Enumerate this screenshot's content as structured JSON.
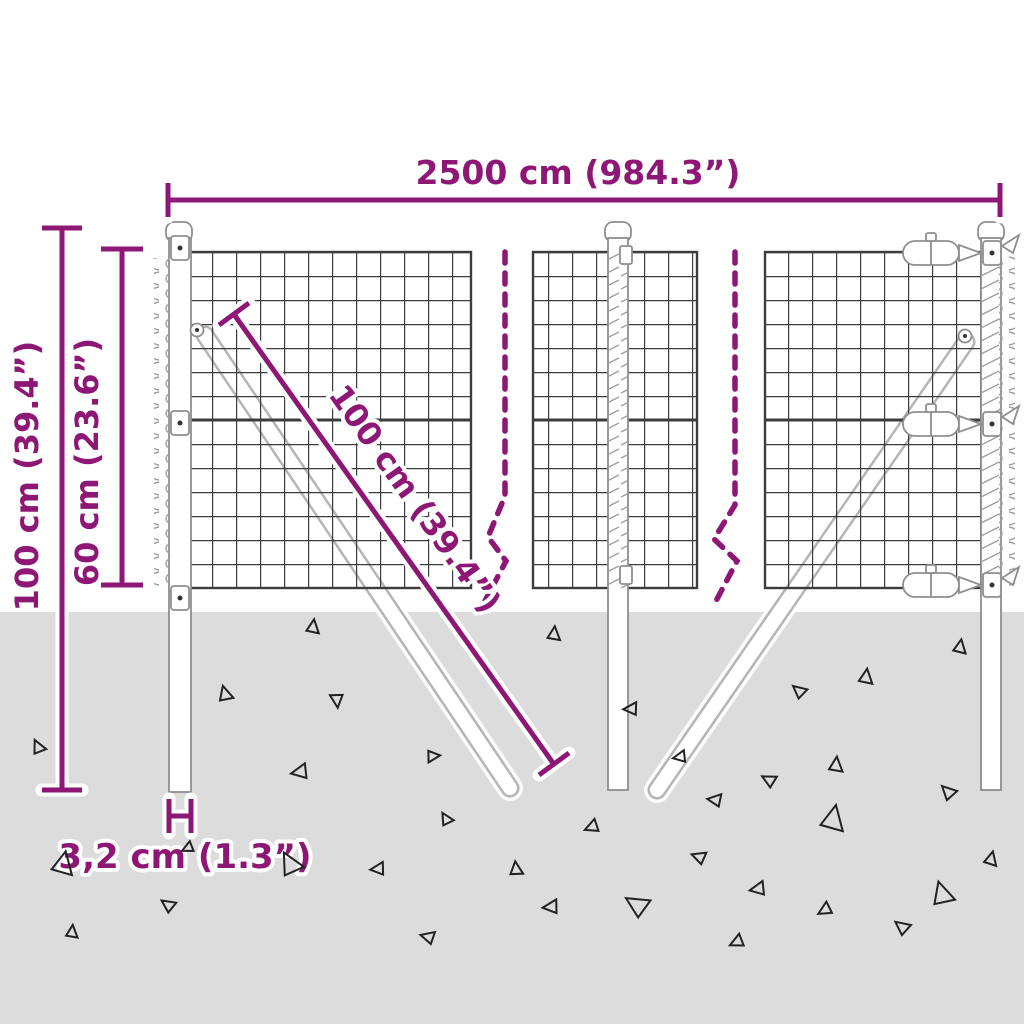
{
  "diagram": {
    "type": "product-dimension-diagram",
    "subject": "wire mesh fence with posts and ground anchoring",
    "labels": {
      "total_width": "2500 cm (984.3”)",
      "total_height": "100 cm (39.4”)",
      "mesh_height": "60 cm (23.6”)",
      "brace_length": "100 cm (39.4”)",
      "post_thickness": "3,2 cm (1.3”)"
    },
    "colors": {
      "accent": "#8E1776",
      "ground": "#DCDCDC",
      "mesh_line": "#3C3C3C",
      "post_stroke": "#8E8E8E",
      "rod_gray": "#B5B5B5",
      "debris": "#222222"
    },
    "ground_triangles": [
      {
        "x": 313,
        "y": 627,
        "s": 12,
        "r": 8
      },
      {
        "x": 225,
        "y": 694,
        "s": 13,
        "r": -15
      },
      {
        "x": 337,
        "y": 700,
        "s": 12,
        "r": 175
      },
      {
        "x": 38,
        "y": 747,
        "s": 12,
        "r": -25
      },
      {
        "x": 433,
        "y": 756,
        "s": 11,
        "r": 85
      },
      {
        "x": 300,
        "y": 772,
        "s": 14,
        "r": -100
      },
      {
        "x": 446,
        "y": 819,
        "s": 11,
        "r": -30
      },
      {
        "x": 63,
        "y": 864,
        "s": 20,
        "r": 12
      },
      {
        "x": 188,
        "y": 848,
        "s": 10,
        "r": -115
      },
      {
        "x": 290,
        "y": 864,
        "s": 20,
        "r": -28
      },
      {
        "x": 378,
        "y": 869,
        "s": 12,
        "r": -95
      },
      {
        "x": 168,
        "y": 905,
        "s": 12,
        "r": -55
      },
      {
        "x": 72,
        "y": 932,
        "s": 11,
        "r": 6
      },
      {
        "x": 428,
        "y": 937,
        "s": 12,
        "r": -75
      },
      {
        "x": 554,
        "y": 634,
        "s": 12,
        "r": 6
      },
      {
        "x": 960,
        "y": 647,
        "s": 12,
        "r": 10
      },
      {
        "x": 866,
        "y": 677,
        "s": 13,
        "r": 8
      },
      {
        "x": 799,
        "y": 691,
        "s": 12,
        "r": -50
      },
      {
        "x": 631,
        "y": 709,
        "s": 12,
        "r": -92
      },
      {
        "x": 680,
        "y": 757,
        "s": 11,
        "r": -100
      },
      {
        "x": 836,
        "y": 765,
        "s": 13,
        "r": 6
      },
      {
        "x": 769,
        "y": 780,
        "s": 12,
        "r": -62
      },
      {
        "x": 948,
        "y": 792,
        "s": 13,
        "r": -45
      },
      {
        "x": 715,
        "y": 800,
        "s": 12,
        "r": -82
      },
      {
        "x": 833,
        "y": 819,
        "s": 22,
        "r": 12
      },
      {
        "x": 592,
        "y": 827,
        "s": 12,
        "r": -112
      },
      {
        "x": 699,
        "y": 857,
        "s": 12,
        "r": -70
      },
      {
        "x": 516,
        "y": 869,
        "s": 12,
        "r": -6
      },
      {
        "x": 991,
        "y": 859,
        "s": 12,
        "r": 14
      },
      {
        "x": 758,
        "y": 889,
        "s": 13,
        "r": -100
      },
      {
        "x": 942,
        "y": 894,
        "s": 20,
        "r": -16
      },
      {
        "x": 551,
        "y": 907,
        "s": 13,
        "r": -95
      },
      {
        "x": 637,
        "y": 905,
        "s": 20,
        "r": -58
      },
      {
        "x": 825,
        "y": 910,
        "s": 12,
        "r": -120
      },
      {
        "x": 902,
        "y": 927,
        "s": 13,
        "r": -52
      },
      {
        "x": 737,
        "y": 942,
        "s": 12,
        "r": -115
      }
    ]
  }
}
